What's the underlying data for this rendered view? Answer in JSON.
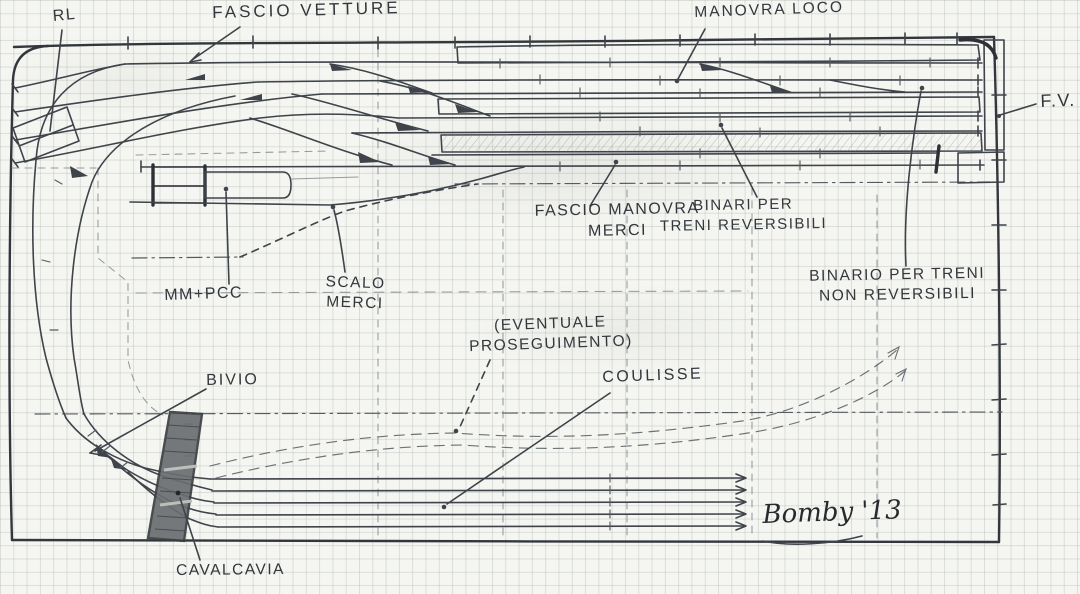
{
  "drawing_type": "hand-drawn model railway track plan sketch on graph paper",
  "colors": {
    "pencil": "#3f434a",
    "paper": "#f5f6f2",
    "grid_line": "#c9cfc9",
    "overpass_fill": "#6b6e71"
  },
  "labels": {
    "rl": "RL",
    "fascio_vetture": "FASCIO VETTURE",
    "manovra_loco": "MANOVRA LOCO",
    "fv": "F.V.",
    "fascio_manovra_merci": "FASCIO MANOVRA\nMERCI",
    "binari_reversibili": "BINARI PER\nTRENI REVERSIBILI",
    "binario_non_reversibili": "BINARIO PER TRENI\nNON REVERSIBILI",
    "mm_pcc": "MM+PCC",
    "scalo_merci": "SCALO\nMERCI",
    "eventuale_proseguimento": "(EVENTUALE\nPROSEGUIMENTO)",
    "coulisse": "COULISSE",
    "bivio": "BIVIO",
    "cavalcavia": "CAVALCAVIA"
  },
  "signature": "Bomby '13"
}
